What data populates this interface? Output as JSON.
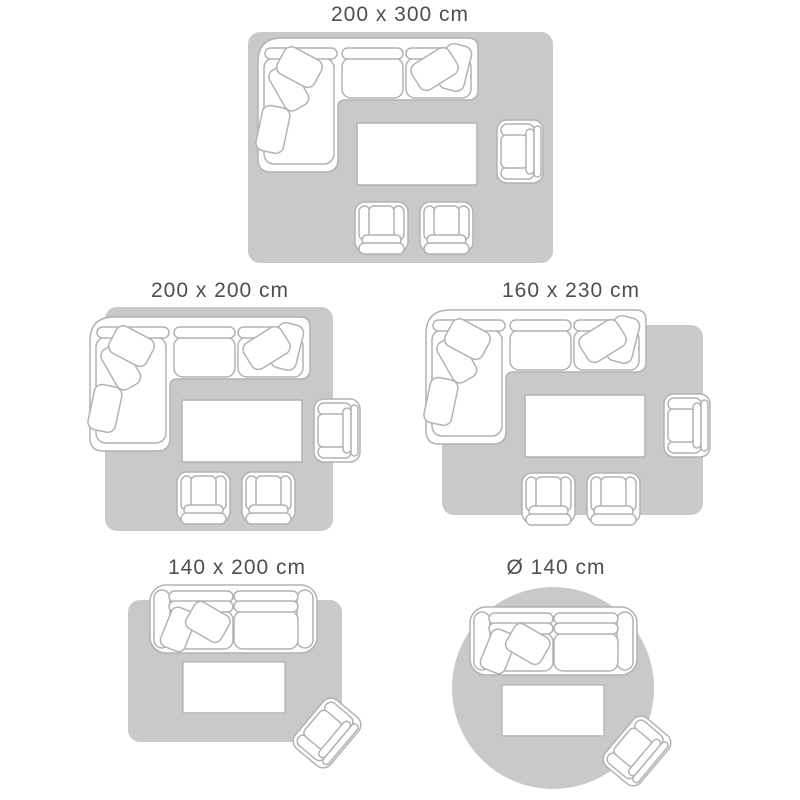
{
  "colors": {
    "background": "#ffffff",
    "rug": "#c9c9c9",
    "outline": "#b2b2b2",
    "fill": "#ffffff",
    "label": "#4d4d54"
  },
  "panels": [
    {
      "id": "rug-200x300",
      "label": "200 x 300 cm",
      "rug_shape": "rectangle"
    },
    {
      "id": "rug-200x200",
      "label": "200 x 200 cm",
      "rug_shape": "rectangle"
    },
    {
      "id": "rug-160x230",
      "label": "160 x 230 cm",
      "rug_shape": "rectangle"
    },
    {
      "id": "rug-140x200",
      "label": "140 x 200 cm",
      "rug_shape": "rectangle"
    },
    {
      "id": "rug-round-140",
      "label": "Ø 140 cm",
      "rug_shape": "circle"
    }
  ],
  "icons": {
    "corner_sofa": "corner-sofa-icon",
    "two_seater_sofa": "two-seater-sofa-icon",
    "coffee_table": "coffee-table-icon",
    "armchair": "armchair-icon",
    "small_armchair": "small-armchair-icon",
    "rectangular_rug": "rect-rug-shape",
    "round_rug": "round-rug-shape"
  }
}
